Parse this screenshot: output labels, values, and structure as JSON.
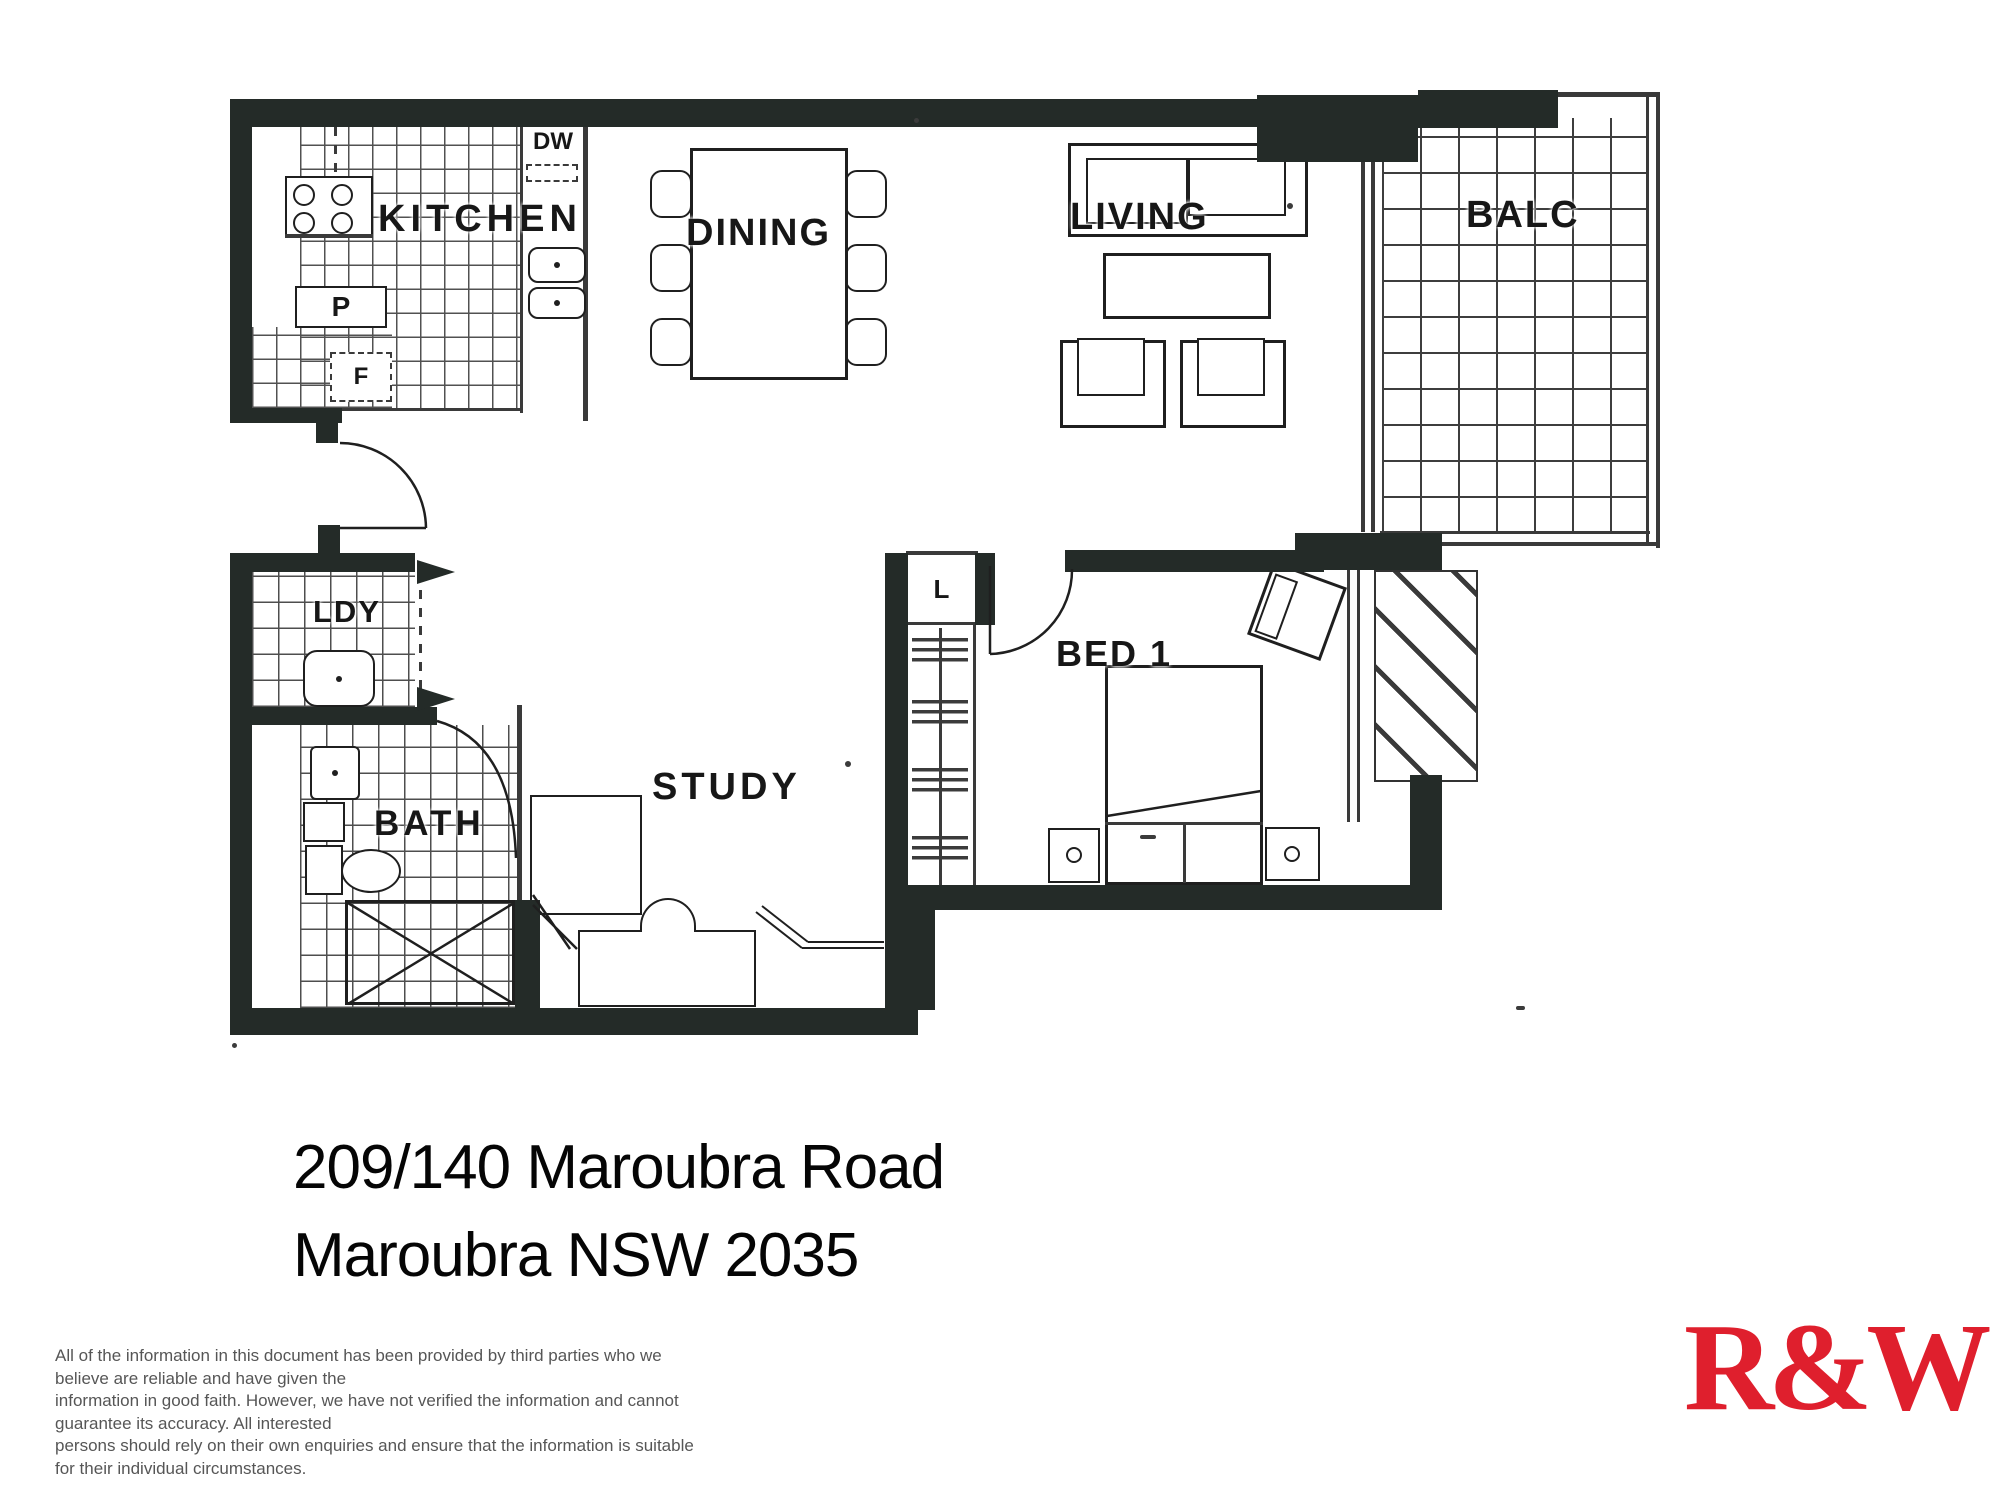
{
  "floorplan": {
    "wall_color": "#242b28",
    "room_labels": {
      "kitchen": "KITCHEN",
      "dining": "DINING",
      "living": "LIVING",
      "balcony": "BALC",
      "laundry": "LDY",
      "bath": "BATH",
      "study": "STUDY",
      "bed1": "BED 1"
    },
    "fixture_labels": {
      "dishwasher": "DW",
      "pantry": "P",
      "fridge": "F",
      "linen": "L"
    }
  },
  "address": {
    "line1": "209/140 Maroubra Road",
    "line2": "Maroubra NSW 2035"
  },
  "disclaimer": {
    "line1": "All of the information in this document has been provided by third parties who we believe are reliable and have given the",
    "line2": "information in good faith. However, we have not verified the information and cannot guarantee its accuracy. All interested",
    "line3": "persons should rely on their own enquiries and ensure that the information is suitable for their individual circumstances."
  },
  "logo": {
    "text": "R&W",
    "color": "#df1f2d"
  }
}
